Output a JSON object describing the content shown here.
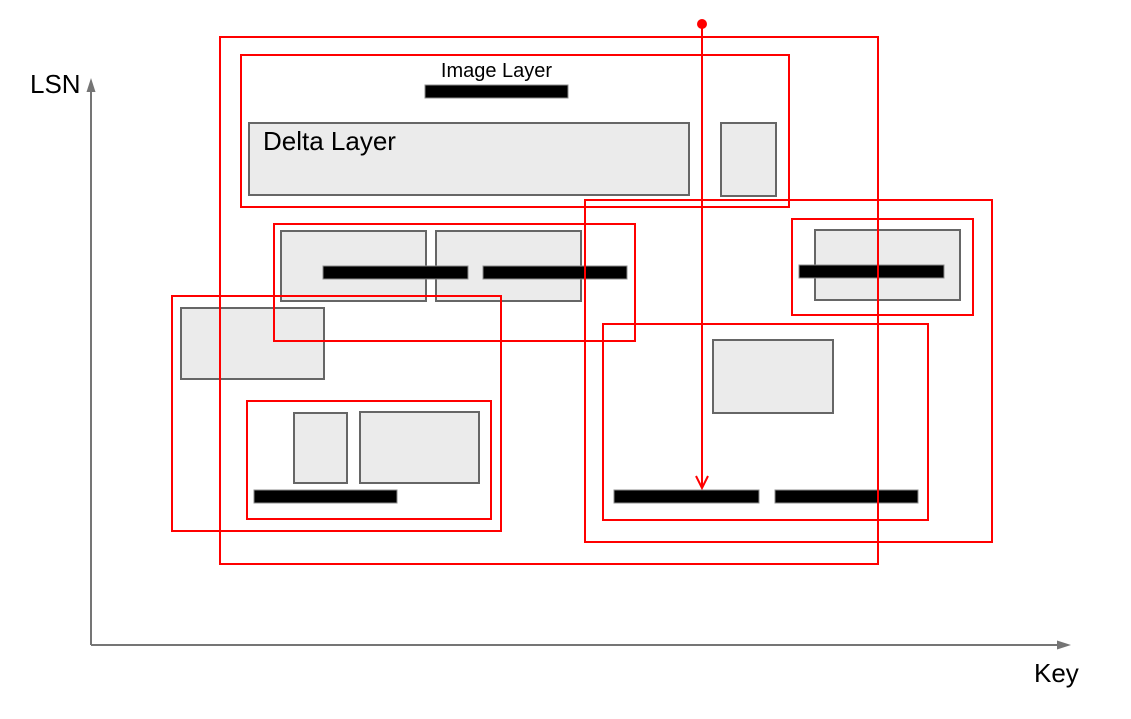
{
  "canvas": {
    "width": 1131,
    "height": 719
  },
  "labels": {
    "y_axis": "LSN",
    "x_axis": "Key",
    "image_layer": "Image Layer",
    "delta_layer": "Delta Layer"
  },
  "colors": {
    "frame_stroke": "#ff0000",
    "box_fill": "#ebebeb",
    "box_border": "#666666",
    "bar_fill": "#000000",
    "bar_border": "#8c8c8c",
    "axis": "#757575",
    "text": "#000000",
    "background": "#ffffff"
  },
  "axes": {
    "origin_x": 91,
    "origin_y": 645,
    "y_arrow_tip": 78,
    "x_arrow_tip": 1071
  },
  "pointer": {
    "x": 702,
    "dot_y": 24,
    "dot_radius": 5,
    "tip_y": 488
  },
  "frames": [
    {
      "name": "outer-main-frame",
      "x": 220,
      "y": 37,
      "w": 658,
      "h": 527
    },
    {
      "name": "image-delta-group-frame",
      "x": 241,
      "y": 55,
      "w": 548,
      "h": 152
    },
    {
      "name": "mid-left-group-frame",
      "x": 274,
      "y": 224,
      "w": 361,
      "h": 117
    },
    {
      "name": "left-group-frame",
      "x": 172,
      "y": 296,
      "w": 329,
      "h": 235
    },
    {
      "name": "bottom-left-inner-frame",
      "x": 247,
      "y": 401,
      "w": 244,
      "h": 118
    },
    {
      "name": "right-small-frame",
      "x": 792,
      "y": 219,
      "w": 181,
      "h": 96
    },
    {
      "name": "right-large-frame",
      "x": 585,
      "y": 200,
      "w": 407,
      "h": 342
    },
    {
      "name": "bottom-middle-inner-frame",
      "x": 603,
      "y": 324,
      "w": 325,
      "h": 196
    }
  ],
  "boxes": [
    {
      "name": "delta-layer-box",
      "x": 249,
      "y": 123,
      "w": 440,
      "h": 72
    },
    {
      "name": "top-small-box",
      "x": 721,
      "y": 123,
      "w": 55,
      "h": 73
    },
    {
      "name": "mid-row-box-1",
      "x": 281,
      "y": 231,
      "w": 145,
      "h": 70
    },
    {
      "name": "mid-row-box-2",
      "x": 436,
      "y": 231,
      "w": 145,
      "h": 70
    },
    {
      "name": "right-box",
      "x": 815,
      "y": 230,
      "w": 145,
      "h": 70
    },
    {
      "name": "left-box",
      "x": 181,
      "y": 308,
      "w": 143,
      "h": 71
    },
    {
      "name": "bottom-left-small-box",
      "x": 294,
      "y": 413,
      "w": 53,
      "h": 70
    },
    {
      "name": "bottom-left-large-box",
      "x": 360,
      "y": 412,
      "w": 119,
      "h": 71
    },
    {
      "name": "bottom-middle-box",
      "x": 713,
      "y": 340,
      "w": 120,
      "h": 73
    }
  ],
  "bars": [
    {
      "name": "image-layer-bar",
      "x": 425,
      "y": 85,
      "w": 143,
      "h": 13
    },
    {
      "name": "mid-bar-1",
      "x": 323,
      "y": 266,
      "w": 145,
      "h": 13
    },
    {
      "name": "mid-bar-2",
      "x": 483,
      "y": 266,
      "w": 144,
      "h": 13
    },
    {
      "name": "right-bar",
      "x": 799,
      "y": 265,
      "w": 145,
      "h": 13
    },
    {
      "name": "bottom-left-bar",
      "x": 254,
      "y": 490,
      "w": 143,
      "h": 13
    },
    {
      "name": "bottom-mid-bar-1",
      "x": 614,
      "y": 490,
      "w": 145,
      "h": 13
    },
    {
      "name": "bottom-mid-bar-2",
      "x": 775,
      "y": 490,
      "w": 143,
      "h": 13
    }
  ]
}
